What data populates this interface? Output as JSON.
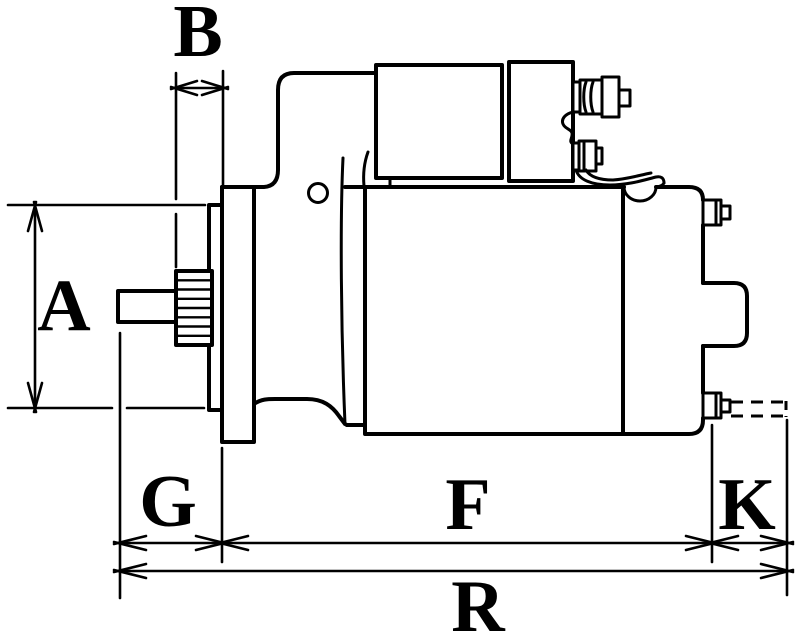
{
  "figure": {
    "type": "technical-dimension-drawing",
    "subject": "starter motor side view",
    "background_color": "#ffffff",
    "line_color": "#000000"
  },
  "labels": {
    "a": "A",
    "b": "B",
    "g": "G",
    "f": "F",
    "k": "K",
    "r": "R"
  },
  "dimensions": [
    {
      "label": "A",
      "axis": "vertical"
    },
    {
      "label": "B",
      "axis": "horizontal"
    },
    {
      "label": "G",
      "axis": "horizontal"
    },
    {
      "label": "F",
      "axis": "horizontal"
    },
    {
      "label": "K",
      "axis": "horizontal"
    },
    {
      "label": "R",
      "axis": "horizontal"
    }
  ]
}
